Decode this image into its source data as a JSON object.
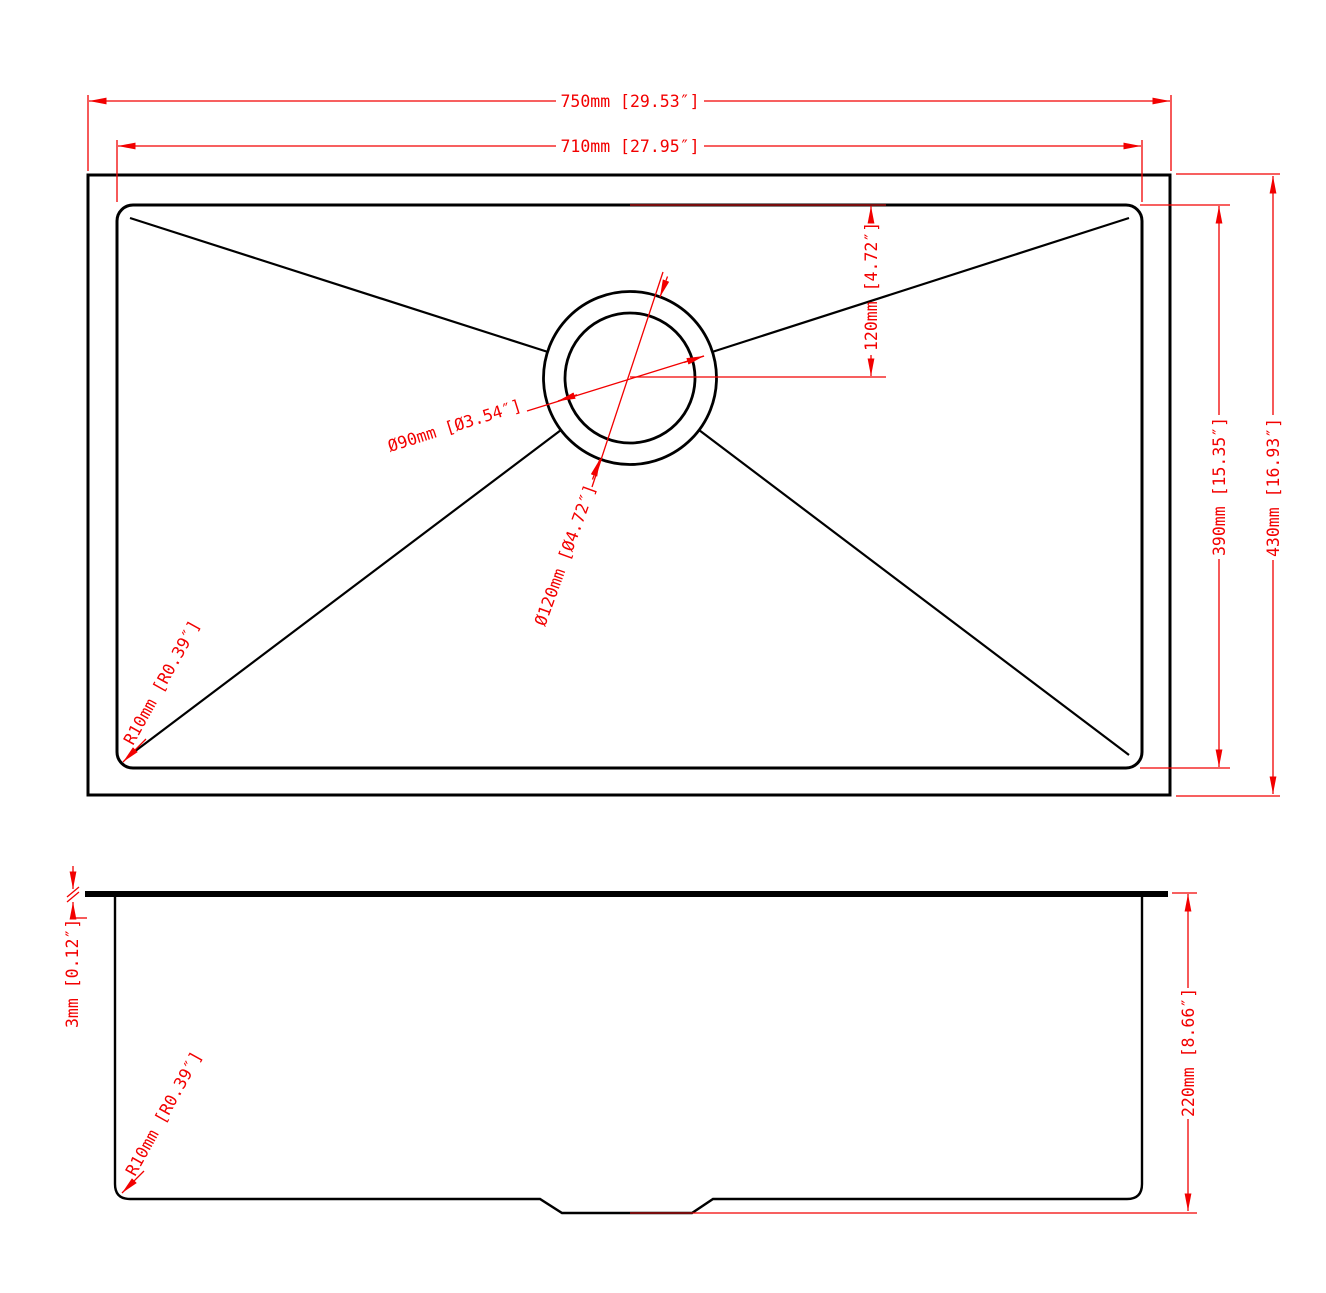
{
  "drawing_type": "sink-dimension-drawing",
  "colors": {
    "dimension": "#f20000",
    "dimension_overlap": "#a01010",
    "outline": "#000000",
    "background": "#ffffff"
  },
  "top_view": {
    "outer_width": "750mm [29.53″]",
    "inner_width": "710mm [27.95″]",
    "drain_offset_from_top": "120mm [4.72″]",
    "inner_depth": "390mm [15.35″]",
    "outer_depth": "430mm [16.93″]",
    "drain_inner_diameter": "Ø90mm [Ø3.54″]",
    "drain_outer_diameter": "Ø120mm [Ø4.72″]",
    "corner_radius": "R10mm [R0.39″]"
  },
  "side_view": {
    "rim_thickness": "3mm [0.12″]",
    "bowl_depth": "220mm [8.66″]",
    "corner_radius": "R10mm [R0.39″]"
  }
}
